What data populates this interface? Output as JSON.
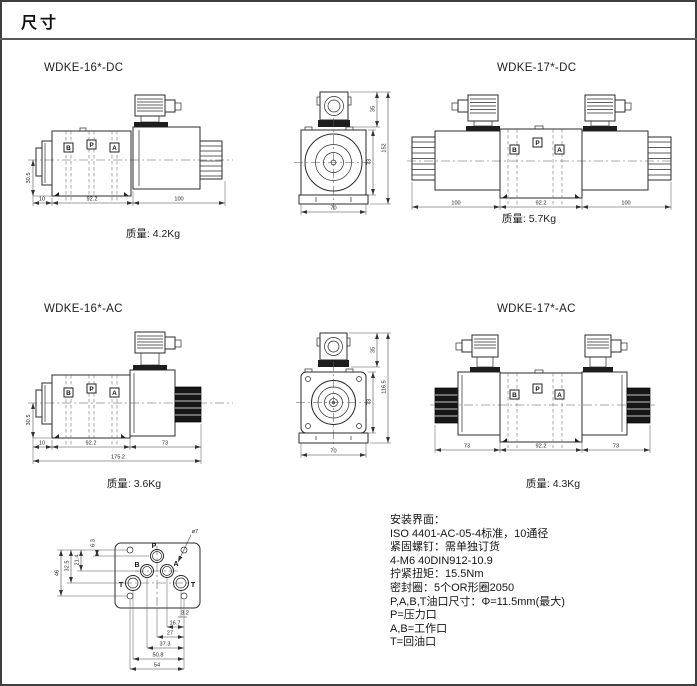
{
  "page": {
    "title": "尺寸"
  },
  "ports": {
    "b": "B",
    "p": "P",
    "a": "A"
  },
  "drawings": {
    "wdke16dc": {
      "label": "WDKE-16*-DC",
      "mass": "质量: 4.2Kg",
      "dims": {
        "height": "30.5",
        "left": "10",
        "body": "92.2",
        "solenoid": "100"
      }
    },
    "front_dc": {
      "dims": {
        "top": "35",
        "body": "73",
        "total": "152",
        "width": "70"
      }
    },
    "wdke17dc": {
      "label": "WDKE-17*-DC",
      "mass": "质量: 5.7Kg",
      "dims": {
        "left": "100",
        "body": "92.2",
        "right": "100"
      }
    },
    "wdke16ac": {
      "label": "WDKE-16*-AC",
      "mass": "质量: 3.6Kg",
      "dims": {
        "height": "30.5",
        "left": "10",
        "body": "92.2",
        "solenoid": "73",
        "total": "175.2"
      }
    },
    "front_ac": {
      "dims": {
        "top": "35",
        "body": "73",
        "total": "116.5",
        "width": "70"
      }
    },
    "wdke17ac": {
      "label": "WDKE-17*-AC",
      "mass": "质量: 4.3Kg",
      "dims": {
        "left": "73",
        "body": "92.2",
        "right": "73"
      }
    },
    "mounting": {
      "hole_label": "ø7",
      "ports": {
        "p": "P",
        "a": "A",
        "b": "B",
        "t_left": "T",
        "t_right": "T"
      },
      "dims": {
        "v1": "6.3",
        "v2": "21.4",
        "v3": "32.5",
        "v4": "46",
        "h1": "3.2",
        "h2": "16.7",
        "h3": "27",
        "h4": "37.3",
        "h5": "50.8",
        "h6": "54"
      }
    }
  },
  "notes": {
    "lines": [
      "安装界面：",
      "ISO 4401-AC-05-4标准，10通径",
      "紧固螺钉：需单独订货",
      "4-M6 40DIN912-10.9",
      "拧紧扭矩：15.5Nm",
      "密封圈：5个OR形圈2050",
      "P,A,B,T油口尺寸：Φ=11.5mm(最大)",
      "P=压力口",
      "A,B=工作口",
      "T=回油口"
    ]
  }
}
